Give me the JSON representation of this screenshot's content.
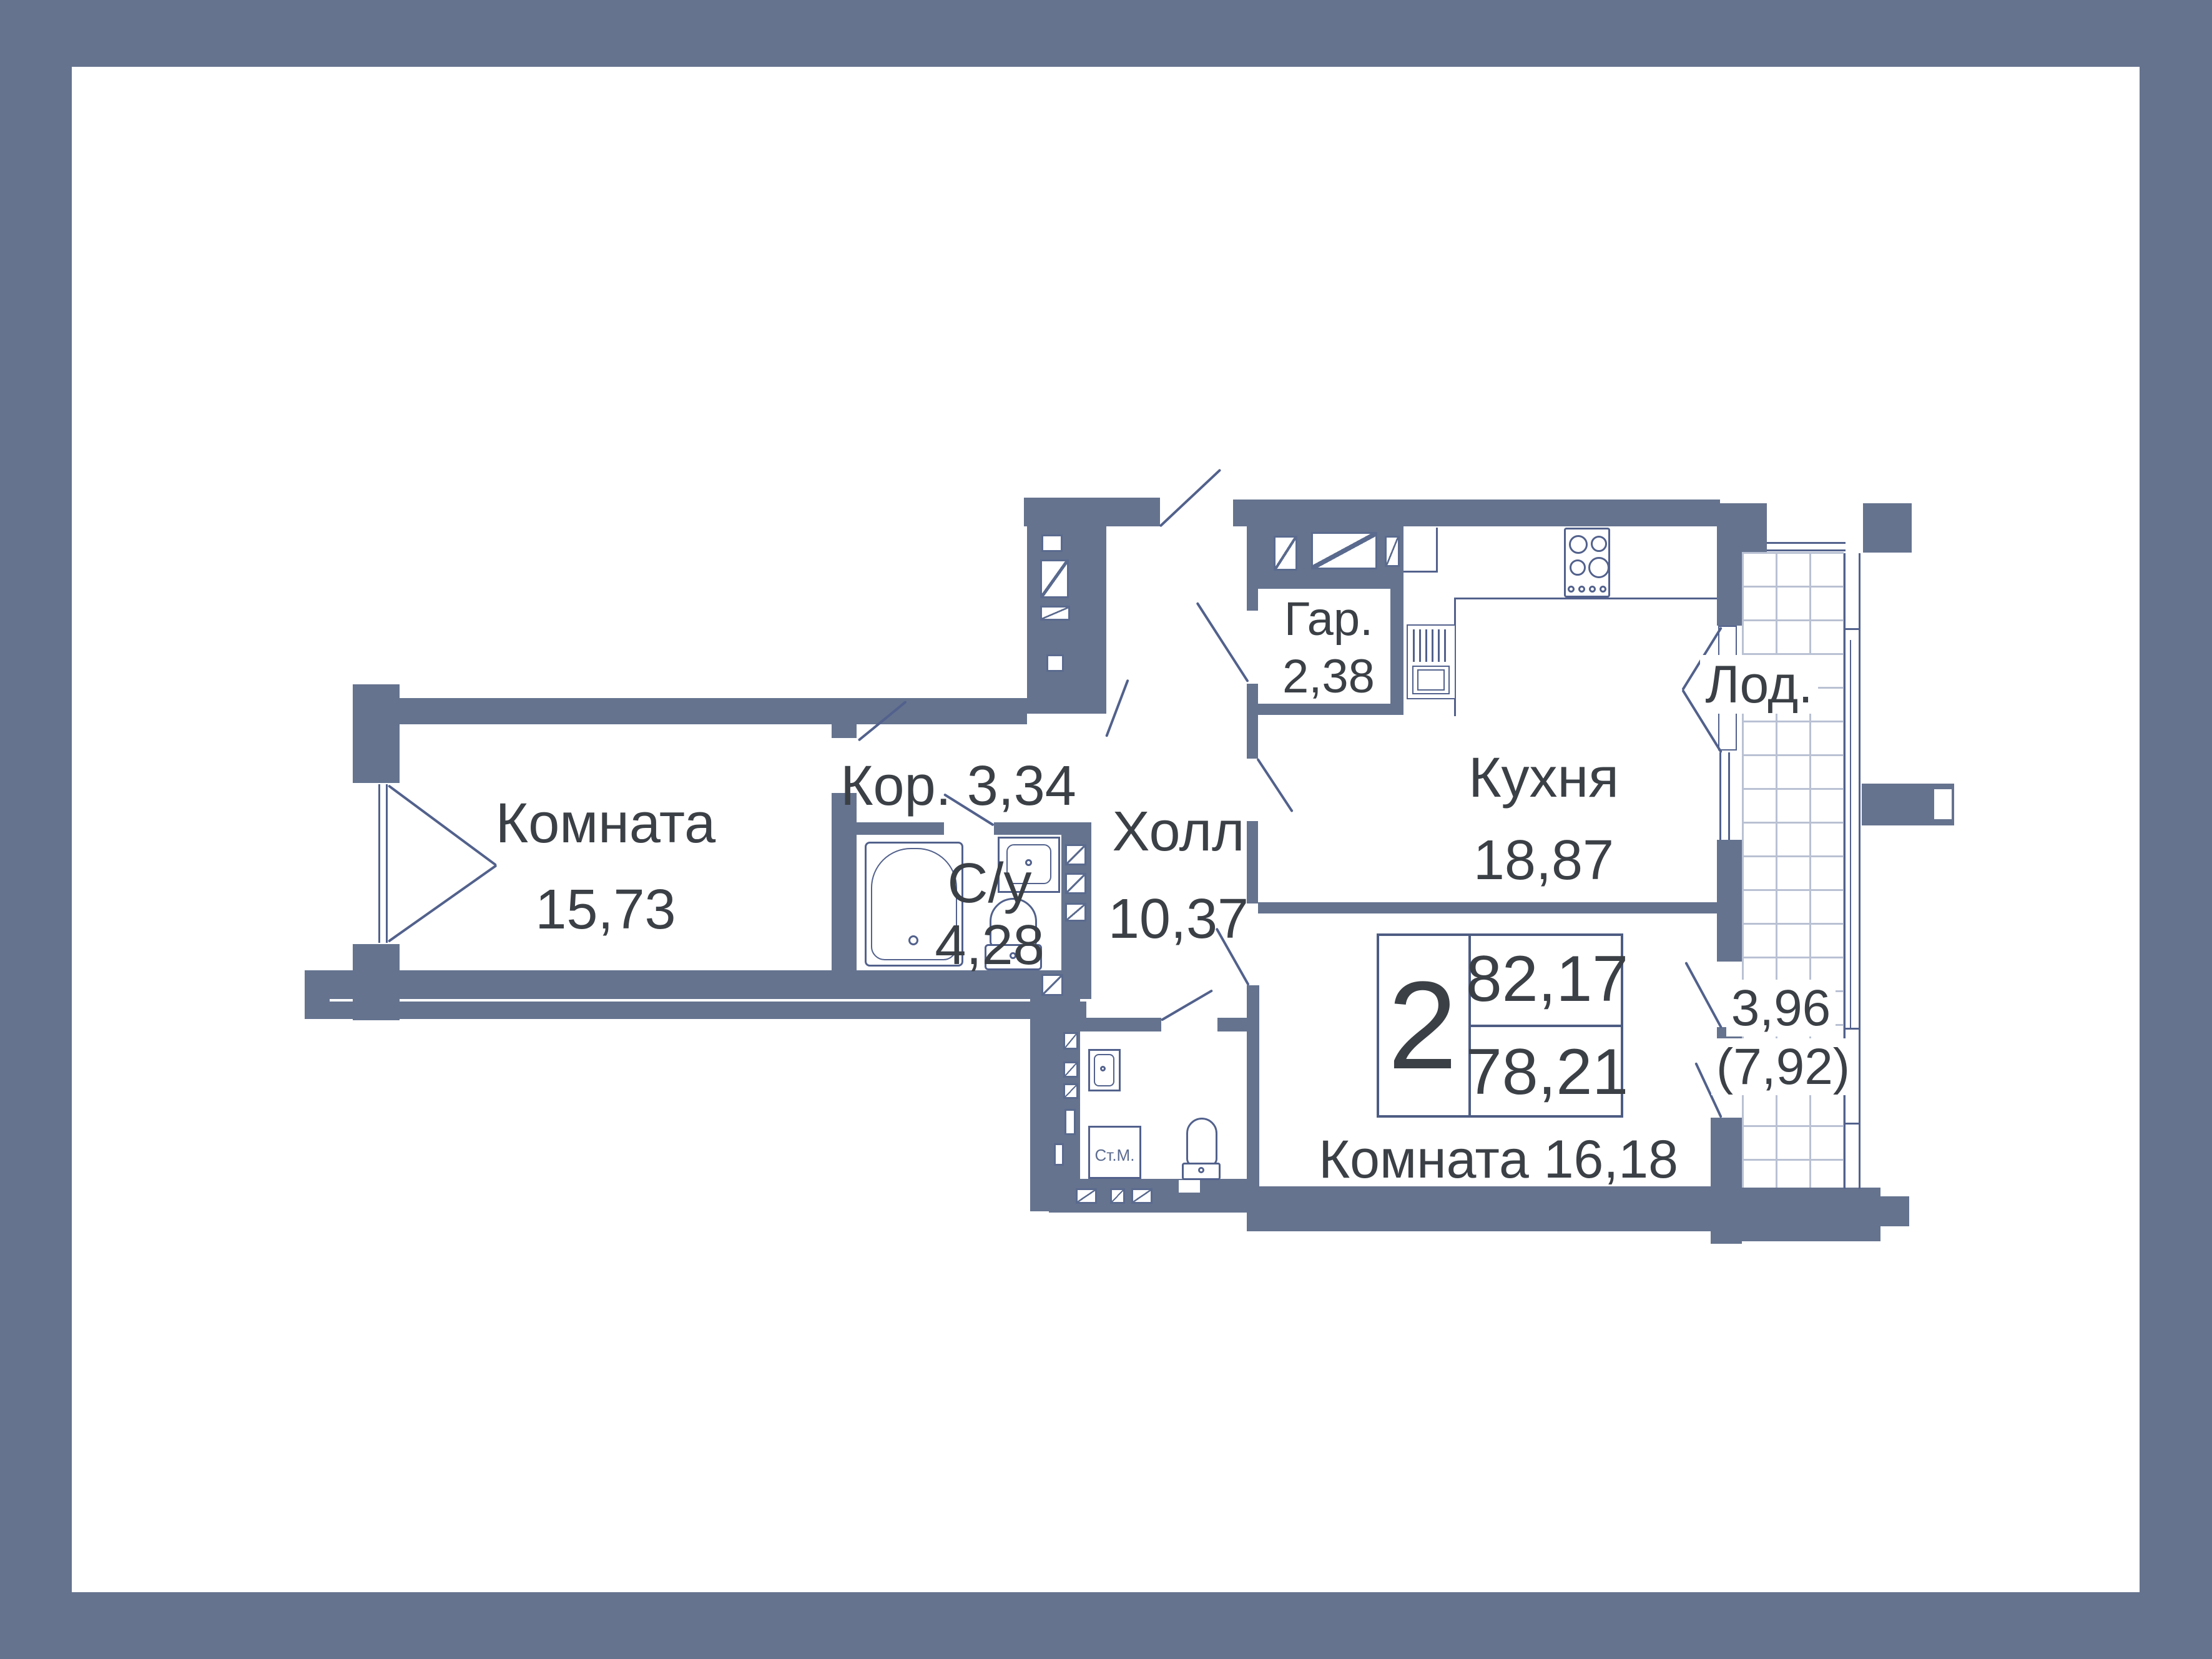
{
  "rooms": {
    "room1": {
      "label": "Комната",
      "area": "15,73"
    },
    "corridor": {
      "label": "Кор.",
      "area": "3,34"
    },
    "bath1": {
      "label": "С/у",
      "area": "4,28"
    },
    "hall": {
      "label": "Холл",
      "area": "10,37"
    },
    "wardrobe": {
      "label": "Гар.",
      "area": "2,38"
    },
    "kitchen": {
      "label": "Кухня",
      "area": "18,87"
    },
    "loggia": {
      "label": "Лод.",
      "area_coefficient": "3,96",
      "area_full": "(7,92)"
    },
    "bath2": {
      "label": "С/у",
      "area": "3,10"
    },
    "room2": {
      "label": "Комната",
      "area": "16,18"
    }
  },
  "summary": {
    "rooms_count": "2",
    "area_total": "82,17",
    "area_living": "78,21"
  },
  "appliances": {
    "washing_machine": "Ст.М."
  },
  "colors": {
    "frame": "#65738f",
    "wall": "#65738f",
    "line": "#52618c",
    "grid_line": "#b9c1d3",
    "text": "#3b4046",
    "bg": "#ffffff"
  }
}
